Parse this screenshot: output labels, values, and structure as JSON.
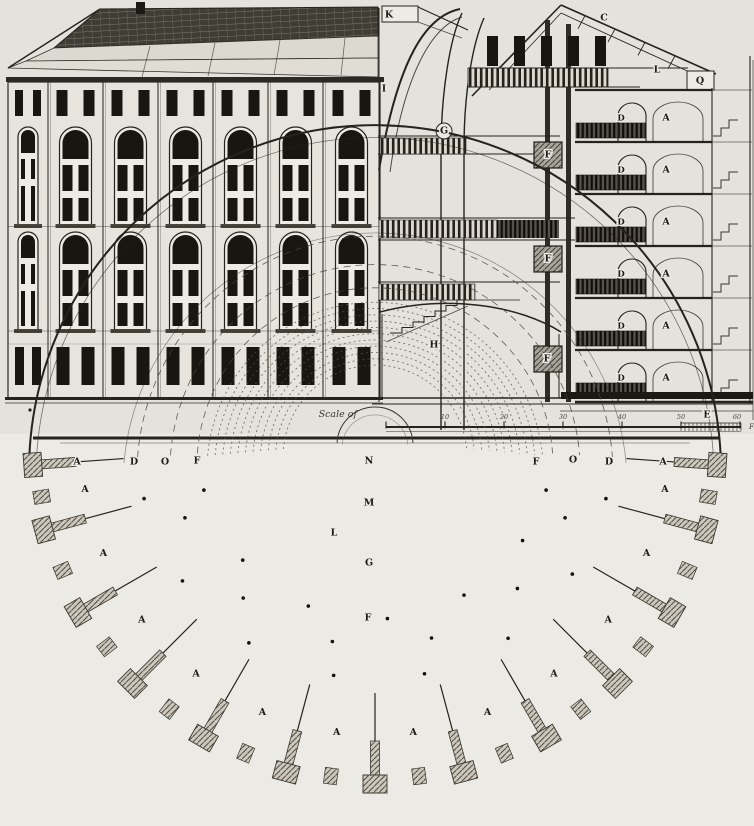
{
  "palette": {
    "paper": "#e9e7e2",
    "paper_upper": "#e4e2dc",
    "paper_plan": "#eceae4",
    "ink": "#26231d",
    "dark_fill": "#181611",
    "pier_gray": "#ccc8bd"
  },
  "scale_bar": {
    "label": "Scale of",
    "tick_labels": [
      "10",
      "20",
      "30",
      "40",
      "50",
      "60"
    ],
    "unit": "Ft"
  },
  "labels": {
    "section": [
      {
        "text": "K",
        "x": 389,
        "y": 15
      },
      {
        "text": "C",
        "x": 604,
        "y": 18
      },
      {
        "text": "I",
        "x": 384,
        "y": 89
      },
      {
        "text": "G",
        "x": 444,
        "y": 131
      },
      {
        "text": "L",
        "x": 657,
        "y": 70
      },
      {
        "text": "Q",
        "x": 700,
        "y": 81
      },
      {
        "text": "F",
        "x": 548,
        "y": 155
      },
      {
        "text": "F",
        "x": 548,
        "y": 259
      },
      {
        "text": "F",
        "x": 547,
        "y": 359
      },
      {
        "text": "H",
        "x": 434,
        "y": 345
      },
      {
        "text": "E",
        "x": 707,
        "y": 415
      }
    ],
    "cell_floor_rows": {
      "left_letter": "D",
      "right_letter": "A",
      "left_x": 621,
      "right_x": 666,
      "first_y": 118,
      "row_step": 52,
      "rows": 6
    },
    "plan_top": [
      {
        "text": "A",
        "x": 77,
        "y": 462
      },
      {
        "text": "D",
        "x": 134,
        "y": 462
      },
      {
        "text": "O",
        "x": 165,
        "y": 462
      },
      {
        "text": "F",
        "x": 197,
        "y": 461
      },
      {
        "text": "N",
        "x": 369,
        "y": 461
      },
      {
        "text": "F",
        "x": 536,
        "y": 462
      },
      {
        "text": "O",
        "x": 573,
        "y": 460
      },
      {
        "text": "D",
        "x": 609,
        "y": 462
      },
      {
        "text": "A",
        "x": 663,
        "y": 462
      }
    ],
    "plan_center": [
      {
        "text": "M",
        "x": 369,
        "y": 503
      },
      {
        "text": "L",
        "x": 334,
        "y": 533
      },
      {
        "text": "G",
        "x": 369,
        "y": 563
      },
      {
        "text": "F",
        "x": 368,
        "y": 618
      }
    ],
    "plan_cells": {
      "letter": "A",
      "count": 12
    }
  }
}
